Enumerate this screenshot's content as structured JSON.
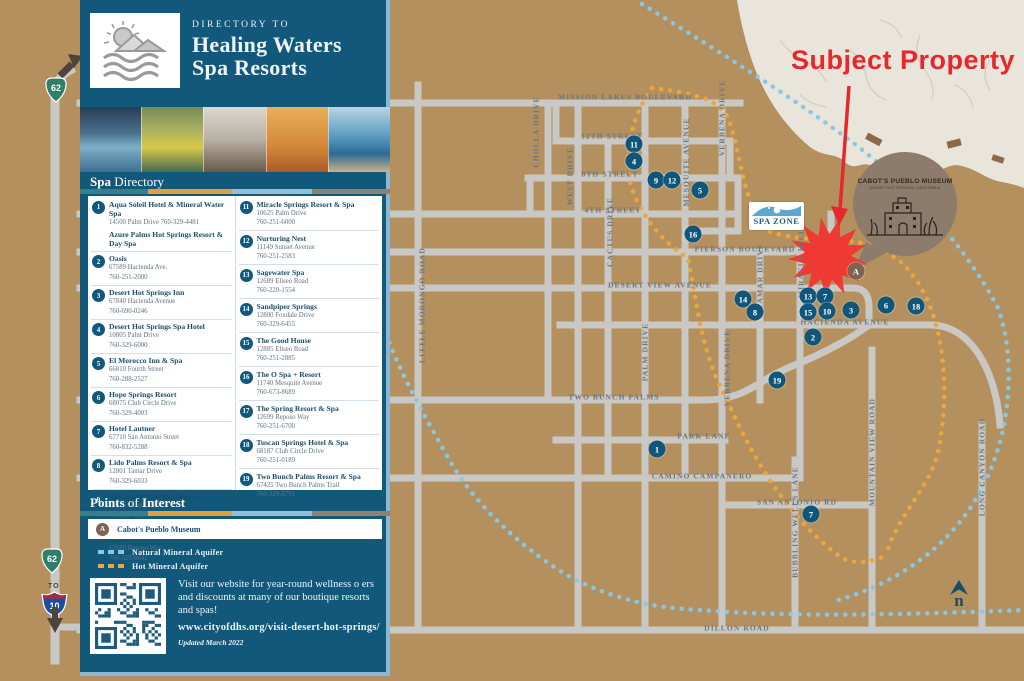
{
  "colors": {
    "sidebar": "#11587a",
    "map_bg": "#b3905e",
    "road": "#cac8c4",
    "orange_aquifer": "#eca63e",
    "blue_aquifer": "#86c8e6",
    "red_accent": "#e4282e",
    "marker_blue": "#0f567a",
    "museum_brown": "#8d7b6b"
  },
  "sidebar": {
    "header": {
      "eyebrow": "DIRECTORY TO",
      "title_line1": "Healing Waters",
      "title_line2": "Spa Resorts"
    },
    "section_spa": {
      "bold": "Spa",
      "regular": " Directory"
    },
    "entries": [
      {
        "num": "1",
        "name": "Aqua Soleil Hotel & Mineral Water Spa",
        "address": "14500 Palm Drive 760-329-4481",
        "extra": "Azure Palms Hot Springs Resort & Day Spa"
      },
      {
        "num": "2",
        "name": "Oasis",
        "address": "67589 Hacienda Ave.",
        "phone": "760-251-2000"
      },
      {
        "num": "3",
        "name": "Desert Hot Springs Inn",
        "address": "67840 Hacienda Avenue",
        "phone": "760-690-0246"
      },
      {
        "num": "4",
        "name": "Desert Hot Springs Spa Hotel",
        "address": "10805 Palm Drive",
        "phone": "760-329-6000"
      },
      {
        "num": "5",
        "name": "El Morocco Inn & Spa",
        "address": "66810 Fourth Street",
        "phone": "760-288-2527"
      },
      {
        "num": "6",
        "name": "Hope Springs Resort",
        "address": "68075 Club Circle Drive",
        "phone": "760-329-4003"
      },
      {
        "num": "7",
        "name": "Hotel Lautner",
        "address": "67710 San Antonio Street",
        "phone": "760-832-5288"
      },
      {
        "num": "8",
        "name": "Lido Palms Resort & Spa",
        "address": "12801 Tamar Drive",
        "phone": "760-329-6033"
      },
      {
        "num": "9",
        "name": "MiKasa Hot Springs Resort",
        "address": "11076 Ocotillo Rd.",
        "phone": "760-853-1004"
      },
      {
        "num": "10",
        "name": "Miracle Manor Boutique Hotel & Spa",
        "address": "12589 Reposo Way",
        "phone": "760-329-6641"
      },
      {
        "num": "11",
        "name": "Miracle Springs Resort & Spa",
        "address": "10625 Palm Drive",
        "phone": "760-251-6000"
      },
      {
        "num": "12",
        "name": "Nurturing Nest",
        "address": "11149 Sunset Avenue",
        "phone": "760-251-2583"
      },
      {
        "num": "13",
        "name": "Sagewater Spa",
        "address": "12689 Eliseo Road",
        "phone": "760-220-1554"
      },
      {
        "num": "14",
        "name": "Sandpiper Springs",
        "address": "12800 Foxdale Drive",
        "phone": "760-329-6455"
      },
      {
        "num": "15",
        "name": "The Good House",
        "address": "12885 Eliseo Road",
        "phone": "760-251-2885"
      },
      {
        "num": "16",
        "name": "The O Spa + Resort",
        "address": "11740 Mesquite Avenue",
        "phone": "760-673-8689"
      },
      {
        "num": "17",
        "name": "The Spring Resort & Spa",
        "address": "12699 Reposo Way",
        "phone": "760-251-6700"
      },
      {
        "num": "18",
        "name": "Tuscan Springs Hotel & Spa",
        "address": "68187 Club Circle Drive",
        "phone": "760-251-0189"
      },
      {
        "num": "19",
        "name": "Two Bunch Palms Resort & Spa",
        "address": "67425 Two Bunch Palms Trail",
        "phone": "760-329-8791"
      }
    ],
    "section_poi": {
      "bold1": "Points",
      "mid": " of ",
      "bold2": "Interest"
    },
    "poi": {
      "marker": "A",
      "name": "Cabot's Pueblo Museum"
    },
    "legend": [
      {
        "label": "Natural Mineral Aquifer",
        "color": "#86c8e6"
      },
      {
        "label": "Hot Mineral Aquifer",
        "color": "#eca63e"
      }
    ],
    "footer": {
      "blurb": "Visit our website for year-round wellness o ers and discounts at many of our boutique resorts and spas!",
      "url": "www.cityofdhs.org/visit-desert-hot-springs/",
      "updated": "Updated March 2022"
    }
  },
  "map": {
    "annotation": "Subject Property",
    "spa_zone": "SPA ZONE",
    "museum_title": "CABOT'S PUEBLO MUSEUM",
    "museum_sub": "DESERT HOT SPRINGS, CALIFORNIA",
    "north_letter": "n",
    "shields": {
      "route62_top": "62",
      "route62_bottom": "62",
      "to": "TO",
      "i10": "10"
    },
    "street_labels": [
      {
        "text": "MISSION LAKES BOULEVARD",
        "x": 625,
        "y": 97
      },
      {
        "text": "12TH STREET",
        "x": 612,
        "y": 136
      },
      {
        "text": "8TH STREET",
        "x": 610,
        "y": 174
      },
      {
        "text": "4TH STREET",
        "x": 613,
        "y": 210
      },
      {
        "text": "PIERSON BOULEVARD",
        "x": 745,
        "y": 249
      },
      {
        "text": "DESERT VIEW AVENUE",
        "x": 660,
        "y": 285
      },
      {
        "text": "HACIENDA AVENUE",
        "x": 845,
        "y": 322
      },
      {
        "text": "TWO BUNCH PALMS",
        "x": 614,
        "y": 397
      },
      {
        "text": "PARK LANE",
        "x": 704,
        "y": 436
      },
      {
        "text": "CAMINO CAMPANERO",
        "x": 702,
        "y": 476
      },
      {
        "text": "SAN ANTONIO RD",
        "x": 797,
        "y": 502
      },
      {
        "text": "DILLON ROAD",
        "x": 737,
        "y": 628
      },
      {
        "text": "LITTLE MORONGO ROAD",
        "x": 422,
        "y": 305,
        "v": 1
      },
      {
        "text": "CHOLLA DRIVE",
        "x": 536,
        "y": 132,
        "v": 1
      },
      {
        "text": "WEST DRIVE",
        "x": 570,
        "y": 176,
        "v": 1
      },
      {
        "text": "CACTUS DRIVE",
        "x": 610,
        "y": 232,
        "v": 1
      },
      {
        "text": "PALM DRIVE",
        "x": 645,
        "y": 352,
        "v": 1
      },
      {
        "text": "MESQUITE AVENUE",
        "x": 686,
        "y": 162,
        "v": 1
      },
      {
        "text": "VERBENA DRIVE",
        "x": 722,
        "y": 118,
        "v": 1
      },
      {
        "text": "VERBENA DRIVE",
        "x": 727,
        "y": 368,
        "v": 1
      },
      {
        "text": "TAMAR DRIVE",
        "x": 760,
        "y": 276,
        "v": 1
      },
      {
        "text": "MIRACLE HILL",
        "x": 801,
        "y": 263,
        "v": 1
      },
      {
        "text": "BUBBLING WELLS LANE",
        "x": 795,
        "y": 522,
        "v": 1
      },
      {
        "text": "MOUNTAIN VIEW ROAD",
        "x": 872,
        "y": 452,
        "v": 1
      },
      {
        "text": "LONG CANYON ROAD",
        "x": 982,
        "y": 467,
        "v": 1
      }
    ],
    "markers": [
      {
        "label": "11",
        "x": 634,
        "y": 144
      },
      {
        "label": "4",
        "x": 634,
        "y": 161
      },
      {
        "label": "9",
        "x": 656,
        "y": 180
      },
      {
        "label": "12",
        "x": 672,
        "y": 180
      },
      {
        "label": "5",
        "x": 700,
        "y": 190
      },
      {
        "label": "16",
        "x": 693,
        "y": 234
      },
      {
        "label": "14",
        "x": 743,
        "y": 299
      },
      {
        "label": "8",
        "x": 755,
        "y": 312
      },
      {
        "label": "13",
        "x": 808,
        "y": 296
      },
      {
        "label": "7",
        "x": 825,
        "y": 296
      },
      {
        "label": "15",
        "x": 808,
        "y": 312
      },
      {
        "label": "10",
        "x": 827,
        "y": 311
      },
      {
        "label": "3",
        "x": 851,
        "y": 310
      },
      {
        "label": "6",
        "x": 886,
        "y": 305
      },
      {
        "label": "18",
        "x": 916,
        "y": 306
      },
      {
        "label": "2",
        "x": 813,
        "y": 337
      },
      {
        "label": "19",
        "x": 777,
        "y": 380
      },
      {
        "label": "1",
        "x": 657,
        "y": 449
      },
      {
        "label": "7",
        "x": 811,
        "y": 514
      },
      {
        "label": "A",
        "x": 856,
        "y": 271,
        "poi": 1
      }
    ]
  }
}
